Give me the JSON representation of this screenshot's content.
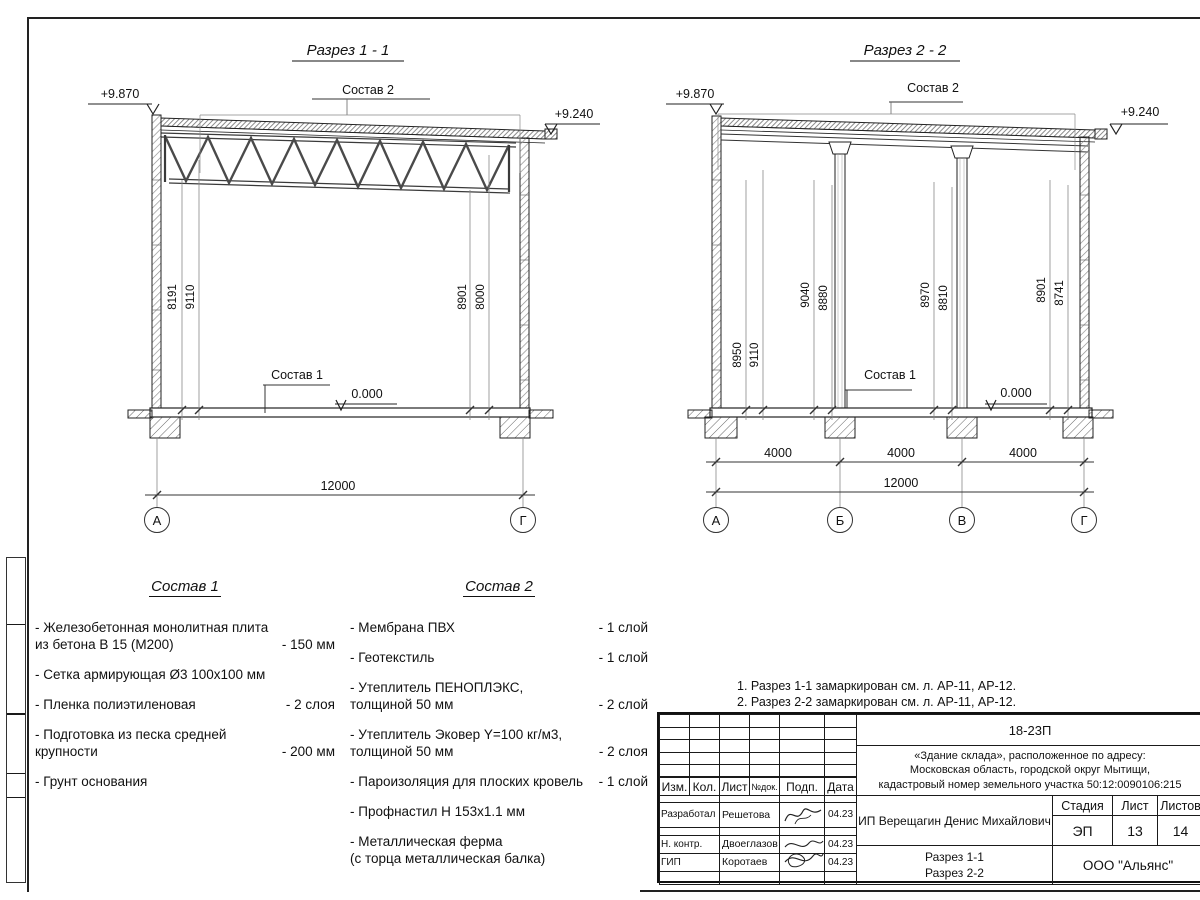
{
  "s1": {
    "title": "Разрез 1 - 1",
    "lvl_top_left": "+9.870",
    "lvl_top_right": "+9.240",
    "lvl_zero": "0.000",
    "callout_roof": "Состав 2",
    "callout_floor": "Состав 1",
    "dim_v1": "8191",
    "dim_v2": "9110",
    "dim_v3": "8901",
    "dim_v4": "8000",
    "dim_total": "12000",
    "axes": [
      "А",
      "Г"
    ]
  },
  "s2": {
    "title": "Разрез 2 - 2",
    "lvl_top_left": "+9.870",
    "lvl_top_right": "+9.240",
    "lvl_zero": "0.000",
    "callout_roof": "Состав 2",
    "callout_floor": "Состав 1",
    "dim_v1": "8950",
    "dim_v2": "9110",
    "dim_v3": "9040",
    "dim_v4": "8880",
    "dim_v5": "8970",
    "dim_v6": "8810",
    "dim_v7": "8901",
    "dim_v8": "8741",
    "dim_span1": "4000",
    "dim_span2": "4000",
    "dim_span3": "4000",
    "dim_total": "12000",
    "axes": [
      "А",
      "Б",
      "В",
      "Г"
    ]
  },
  "sostav1": {
    "title": "Состав 1",
    "items": [
      {
        "name": "- Железобетонная  монолитная плита\nиз бетона В 15 (М200)",
        "value": "- 150 мм"
      },
      {
        "name": "- Сетка армирующая Ø3 100х100 мм",
        "value": ""
      },
      {
        "name": "- Пленка полиэтиленовая",
        "value": "-  2 слоя"
      },
      {
        "name": "- Подготовка из песка средней\nкрупности",
        "value": "- 200 мм"
      },
      {
        "name": "- Грунт основания",
        "value": ""
      }
    ]
  },
  "sostav2": {
    "title": "Состав 2",
    "items": [
      {
        "name": "- Мембрана ПВХ",
        "value": "- 1 слой"
      },
      {
        "name": "- Геотекстиль",
        "value": "- 1 слой"
      },
      {
        "name": "- Утеплитель ПЕНОПЛЭКС,\nтолщиной 50 мм",
        "value": "- 2 слой"
      },
      {
        "name": "- Утеплитель Эковер Y=100 кг/м3,\nтолщиной 50 мм",
        "value": "- 2 слоя"
      },
      {
        "name": "- Пароизоляция для плоских кровель",
        "value": "- 1 слой"
      },
      {
        "name": "- Профнастил Н 153х1.1 мм",
        "value": ""
      },
      {
        "name": "- Металлическая ферма\n(с торца металлическая балка)",
        "value": ""
      }
    ]
  },
  "notes": {
    "line1": "1. Разрез 1-1 замаркирован см. л. АР-11, АР-12.",
    "line2": "2. Разрез 2-2 замаркирован см. л. АР-11, АР-12."
  },
  "tb": {
    "doc_number": "18-23П",
    "object": "«Здание склада», расположенное по адресу:\nМосковская область, городской округ Мытищи,\nкадастровый номер земельного участка 50:12:0090106:215",
    "client": "ИП Верещагин Денис Михайлович",
    "stage_label": "Стадия",
    "sheet_label": "Лист",
    "sheets_label": "Листов",
    "stage": "ЭП",
    "sheet": "13",
    "sheets": "14",
    "content": "Разрез 1-1\nРазрез 2-2",
    "company": "ООО \"Альянс\"",
    "header": {
      "izm": "Изм.",
      "kol": "Кол.",
      "list": "Лист",
      "ndok": "№док.",
      "podp": "Подп.",
      "data": "Дата"
    },
    "rows": [
      {
        "role": "Разработал",
        "name": "Решетова",
        "date": "04.23"
      },
      {
        "role": "Н. контр.",
        "name": "Двоеглазов",
        "date": "04.23"
      },
      {
        "role": "ГИП",
        "name": "Коротаев",
        "date": "04.23"
      }
    ]
  }
}
